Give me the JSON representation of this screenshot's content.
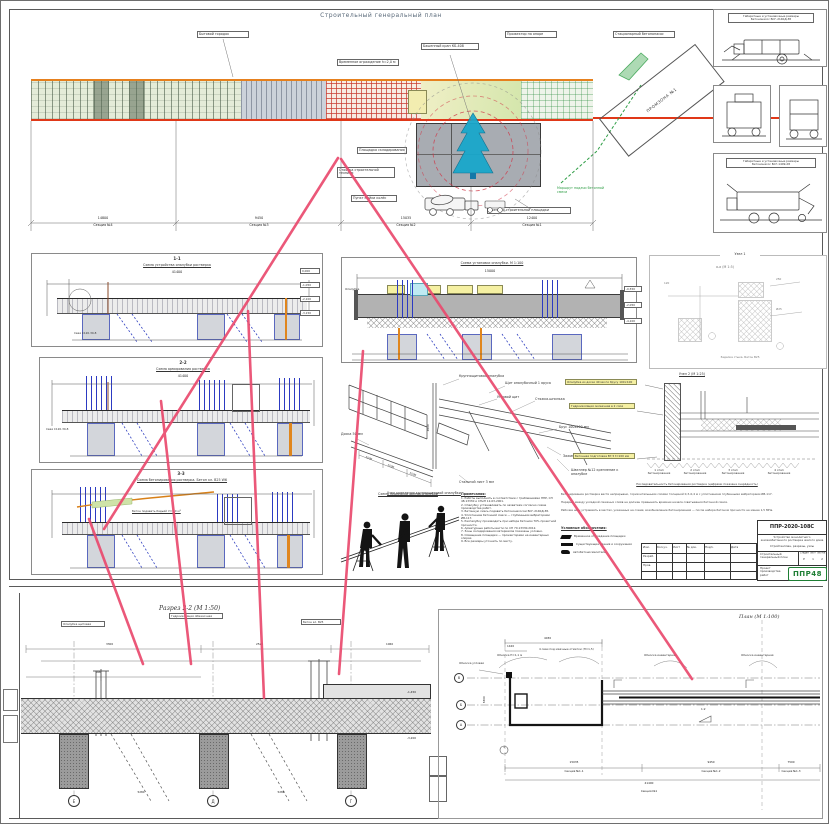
{
  "colors": {
    "pink": "#ea4a6e",
    "orange": "#e6801e",
    "red": "#e03818",
    "green": "#2f9e46",
    "blue": "#2c3ac2",
    "logo_green": "#1e7e34"
  },
  "header": {
    "title": "Строительный генеральный план"
  },
  "top_plan": {
    "callouts": {
      "c1": "Бытовой городок",
      "c2": "Временное ограждение h=2,0 м",
      "c3": "Башенный кран КБ-408",
      "c4": "Прожектор на опоре",
      "c5": "Площадка складирования",
      "c6": "Стоянка строительной техники",
      "c7": "Пункт мойки колёс",
      "c8": "Выезд со строительной площадки",
      "c9": "Стационарный бетононасос",
      "c10": "Маршрут подачи бетонной смеси"
    },
    "zone_label": "ПРОМЗОНА №1",
    "dims": [
      {
        "value": "14800",
        "label": "Секция №4"
      },
      {
        "value": "9450",
        "label": "Секция №3"
      },
      {
        "value": "15035",
        "label": "Секция №2"
      },
      {
        "value": "12400",
        "label": "Секция №1"
      }
    ]
  },
  "equipment": {
    "p1_title_1": "Габаритные и установочные размеры",
    "p1_title_2": "Бетононасос БСГ-2140Д-38",
    "p4_title_1": "Габаритные и установочные размеры",
    "p4_title_2": "Бетононасос БСГ-1409-28"
  },
  "sections": {
    "a": {
      "mark": "1-1",
      "title": "Схема устройства опалубки ростверка",
      "dim": "41400"
    },
    "b": {
      "mark": "2-2",
      "title": "Схема армирования ростверка",
      "dim": "41400"
    },
    "c": {
      "mark": "3-3",
      "title": "Схема бетонирования ростверка. Бетон кл. В25 W6",
      "dim": "41400",
      "note": "Бетон подавать бадьёй V=1,0 м³"
    },
    "m": {
      "mark": "4-4",
      "title": "Схема установки опалубки. М 1:100",
      "dim": "15000",
      "label": "Опалубка"
    },
    "elevations": [
      "0,000",
      "-1,050",
      "-2,100",
      "-3,150"
    ],
    "m_elevations": [
      "-0,550",
      "-2,050",
      "-4,100"
    ],
    "pile_label": "Свая С120.30-8"
  },
  "iso": {
    "title": "Узел крепления крупнощитовой опалубки",
    "callouts": [
      "Крупнощитовая опалубка",
      "Щит опалубочный 1 яруса",
      "Угловой щит",
      "Стяжка-шпилька",
      "Брус 100х200 мм",
      "Зажим стальной 50х2,6 мм",
      "Швеллер №12 крепление к опалубке",
      "Стальной лист 3 мм",
      "Доска 50 мм"
    ],
    "dims": [
      "1500",
      "1500",
      "1500",
      "4500"
    ]
  },
  "detail1": {
    "title": "Узел 1",
    "subtitle": "а-а (М 1:5)",
    "caption": "Заделка стыка. Бетон В25",
    "dims": [
      "120",
      "250",
      "Ø25"
    ]
  },
  "detail2": {
    "title": "Узел 2 (М 1:25)",
    "labels": [
      "Опалубка из доски 40 мм по брусу 100×100",
      "Гидроизоляция оклеечная в 2 слоя",
      "Бетонная подготовка В7,5 t=100 мм"
    ],
    "stages": [
      "1 этап бетонирования",
      "2 этап бетонирования",
      "3 этап бетонирования",
      "4 этап бетонирования"
    ],
    "caption": "Последовательность бетонирования ростверка (цифрами показана очерёдность)",
    "paragraph": [
      "Бетонирование ростверка вести непрерывно, горизонтальными слоями толщиной 0,3–0,4 м с уплотнением глубинными вибраторами ИВ-117.",
      "Перерыв между укладкой смежных слоёв не должен превышать времени начала схватывания бетонной смеси.",
      "Рабочие швы устраивать в местах, указанных на схеме; возобновление бетонирования — после набора бетоном прочности не менее 1,5 МПа."
    ]
  },
  "workers": {
    "title": "Схема переноски щитов опалубки"
  },
  "notes": {
    "title": "Примечания:",
    "lines": [
      "1. Работы выполнять в соответствии с требованиями ППР, СП 48.13330 и СНиП 12-03-2001.",
      "2. Опалубку устанавливать по захваткам согласно схеме производства работ.",
      "3. Бетонную смесь подавать бетононасосом БСГ-2140Д-38.",
      "4. Уплотнение бетонной смеси — глубинными вибраторами ИВ-117.",
      "5. Распалубку производить при наборе бетоном 70% проектной прочности.",
      "6. Арматурные работы вести по СП 70.13330.2012.",
      "7. Зоны складирования материалов показаны условно.",
      "8. Освещение площадки — прожекторами на инвентарных опорах.",
      "9. Все размеры уточнить по месту."
    ]
  },
  "legend": {
    "title": "Условные обозначения:",
    "items": [
      "Временное ограждение площадки",
      "Существующие здания и сооружения",
      "Автобетоносмеситель"
    ]
  },
  "stamp": {
    "doc_no": "ППР-2020-108С",
    "desc_1": "Устройство монолитного железобетонного ростверка жилого дома",
    "desc_2": "Стройгенплан, разрезы, узлы",
    "section_cell": "Строительный генеральный план",
    "stage_h": "Стадия",
    "sheet_h": "Лист",
    "sheets_h": "Листов",
    "stage": "Р",
    "sheet": "1",
    "sheets": "2",
    "org": "Проект производства работ",
    "logo": "ППР48",
    "cols": [
      "Изм.",
      "Кол.уч.",
      "Лист",
      "№ док.",
      "Подп.",
      "Дата"
    ],
    "rows": [
      "Разраб.",
      "Пров."
    ]
  },
  "bottom_left": {
    "title": "Разрез 2-2 (М 1:50)",
    "axes": [
      "Е",
      "Д",
      "Г"
    ],
    "callouts": [
      "Опалубка щитовая",
      "Гидроизоляция обмазочная",
      "Бетон кл. В25"
    ],
    "top_dims": [
      "3300",
      "2520",
      "1060"
    ],
    "mid_dim": "900",
    "bottom_dims": [
      "5280",
      "5280"
    ],
    "elevations": [
      "-1,450",
      "-3,200"
    ]
  },
  "bottom_right": {
    "title": "План (М 1:100)",
    "axes": [
      "В",
      "Б",
      "А"
    ],
    "callouts": [
      "Обноска угловая",
      "Обноска Н=1,1 м",
      "4 сваи под маячные отметки (Н≈1,5)",
      "Обноска инвентарная",
      "Обноска инвентарная"
    ],
    "top_dims": [
      "1420",
      "4030"
    ],
    "v_dim": "6300",
    "slope": "1:2",
    "mark": "1",
    "dims": [
      {
        "value": "15035",
        "label": "Секция №1.1"
      },
      {
        "value": "9450",
        "label": "Секция №1.2"
      },
      {
        "value": "7500",
        "label": "Секция №1.3"
      }
    ],
    "overall": {
      "value": "41400",
      "label": "Секция №1"
    }
  }
}
